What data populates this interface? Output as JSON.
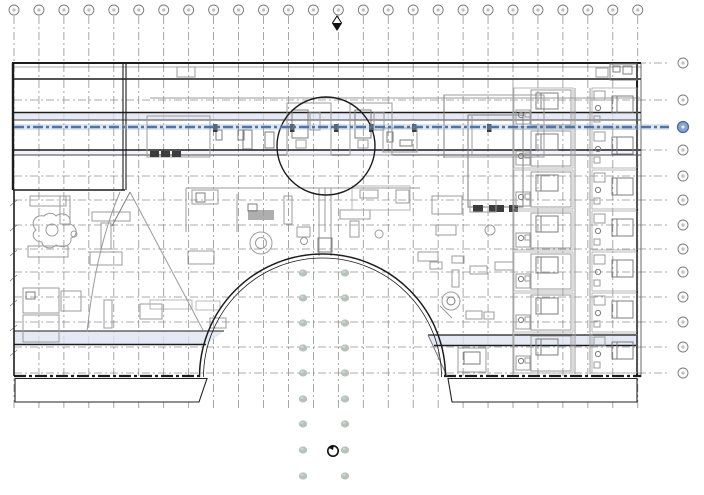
{
  "app": {
    "title": "Architectural floor plan view (CAD) with structural grid, guest-room wings, central circular stair and semicircular atrium",
    "visible_text": "none — grid bubble numbers are rendered too small to be legible",
    "labels_legible": false
  },
  "colors": {
    "background": "#ffffff",
    "grid_line": "#8a8a8a",
    "bubble_stroke": "#7a7a7a",
    "bubble_fill": "#fbfbfb",
    "wall_dark": "#1c1c1c",
    "wall_mid": "#444444",
    "wall_gray": "#9b9b9b",
    "furniture_gray": "#a9a9a9",
    "selected_blue": "#4f74a8",
    "selected_blue_glow": "#9fb4d8",
    "selected_bubble_fill": "#8ba3cc",
    "band_lavender": "#dfe3f1",
    "dot_green": "#b7c2ba",
    "marker_black": "#111111"
  },
  "grid": {
    "columns": 26,
    "rows": 13,
    "selected_row_index": 2,
    "selection_note": "one horizontal grid line is selected/highlighted in blue with a filled blue bubble at its right end"
  },
  "dots": {
    "columns": 2,
    "rows": 9,
    "note": "two vertical columns of small gray-green dot symbols running down through the atrium opening"
  },
  "guest_rooms": {
    "strips": 2,
    "modules_per_strip": 7
  },
  "markers": {
    "top": "grid bubble with small black-and-white diamond marker below it",
    "bottom": "small circular marker with black tick, centered between the dot columns"
  }
}
